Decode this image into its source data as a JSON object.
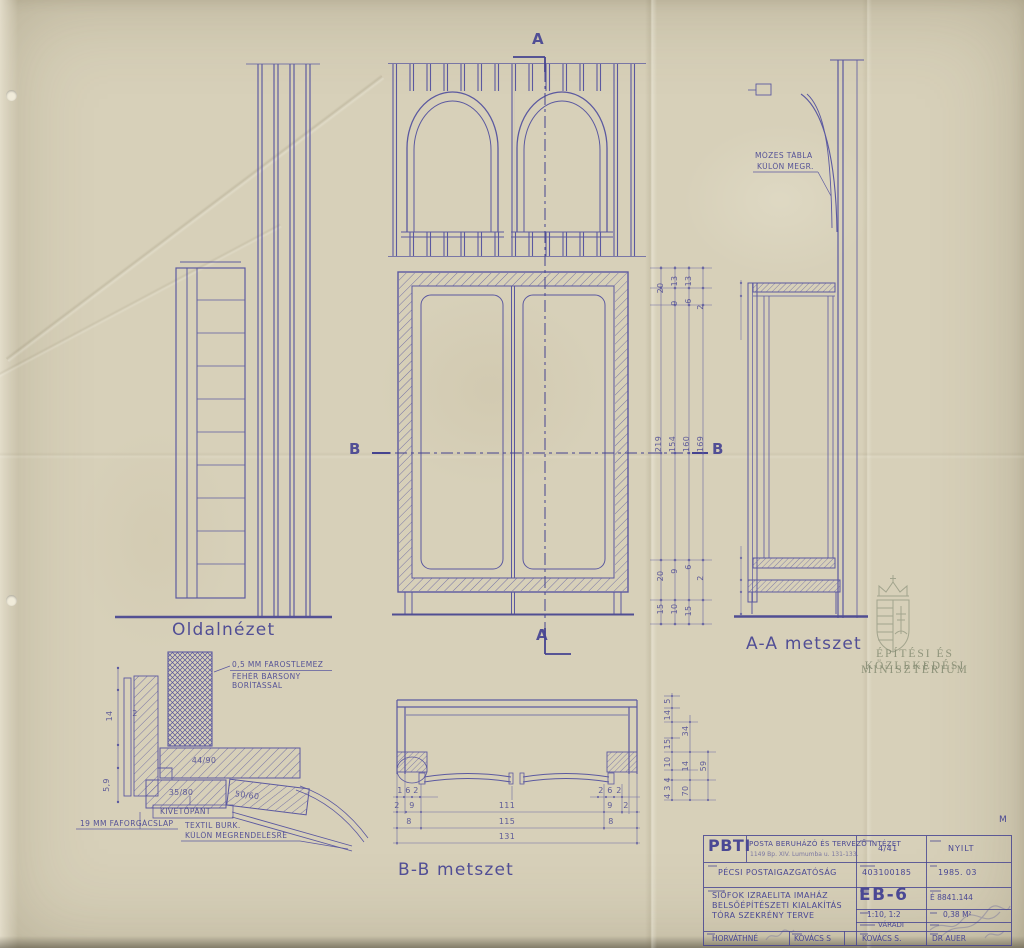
{
  "sheet": {
    "titles": {
      "side_view": "Oldalnézet",
      "section_aa": "A-A metszet",
      "section_bb": "B-B metszet"
    },
    "markers": {
      "a": "A",
      "b": "B",
      "corner": "M"
    }
  },
  "notes": {
    "mozes_1": "MÓZES TÁBLA",
    "mozes_2": "KÜLÖN MEGR.",
    "farost_1": "0,5 MM FAROSTLEMEZ",
    "farost_2": "FEHÉR BÁRSONY",
    "farost_3": "BORÍTÁSSAL",
    "kiveto": "KIVETŐPÁNT",
    "faforgacs": "19 MM FAFORGÁCSLAP",
    "textil_1": "TEXTIL BURK.",
    "textil_2": "KÜLÖN MEGRENDELÉSRE"
  },
  "watermark": {
    "line1": "ÉPÍTÉSI ÉS KÖZLEKEDÉSI",
    "line2": "MINISZTÉRIUM"
  },
  "dims": {
    "top_cluster": [
      "20",
      "13",
      "13",
      "9",
      "6",
      "2"
    ],
    "heights": [
      "219",
      "154",
      "160",
      "169"
    ],
    "bottom_cluster": [
      "20",
      "9",
      "6",
      "2",
      "15",
      "10",
      "15"
    ],
    "bb_right": [
      "5",
      "14",
      "34",
      "15",
      "10",
      "14",
      "4 3 4",
      "59",
      "70"
    ],
    "bb_row1_left": [
      "1",
      "6",
      "2"
    ],
    "bb_row1_right": [
      "2",
      "6",
      "2"
    ],
    "bb_row2": [
      "2",
      "9",
      "111",
      "9",
      "2"
    ],
    "bb_row3": [
      "8",
      "115",
      "8"
    ],
    "bb_row4": "131",
    "detail_left": [
      "14",
      "2",
      "5,9"
    ],
    "detail_sizes": [
      "44/90",
      "35/80",
      "50/60"
    ]
  },
  "title_block": {
    "logo": "PBTI",
    "company": "POSTA BERUHÁZÓ ÉS TERVEZŐ INTÉZET",
    "address": "1149 Bp. XIV. Lumumba u. 131-133.",
    "code": "4/41",
    "classification": "NYILT",
    "client": "PÉCSI POSTAIGAZGATÓSÁG",
    "job_number": "403100185",
    "date": "1985. 03",
    "project_line1": "SIÓFOK IZRAELITA IMAHÁZ",
    "project_line2": "BELSŐÉPÍTÉSZETI KIALAKÍTÁS",
    "project_line3": "TÓRA SZEKRÉNY TERVE",
    "drawing_number": "EB-6",
    "archive_number": "É 8841.144",
    "scale": "1:10, 1:2",
    "area": "0,38 M²",
    "editor": "VÁRADI",
    "drafter": "HORVÁTHNÉ",
    "designer": "KOVÁCS S",
    "lead_designer": "KOVÁCS S.",
    "approved_by": "DR AUER"
  }
}
